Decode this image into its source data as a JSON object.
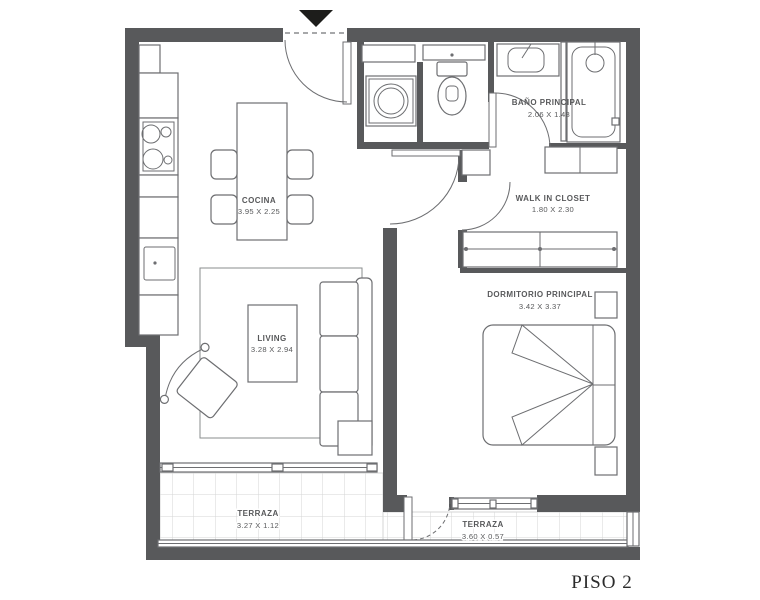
{
  "plan": {
    "floor_label": "PISO 2",
    "rooms": {
      "cocina": {
        "name": "COCINA",
        "dims": "3.95 X 2.25"
      },
      "living": {
        "name": "LIVING",
        "dims": "3.28 X 2.94"
      },
      "bano": {
        "name": "BAÑO PRINCIPAL",
        "dims": "2.06 X 1.48"
      },
      "closet": {
        "name": "WALK IN CLOSET",
        "dims": "1.80 X 2.30"
      },
      "dormitorio": {
        "name": "DORMITORIO PRINCIPAL",
        "dims": "3.42 X 3.37"
      },
      "terraza_living": {
        "name": "TERRAZA",
        "dims": "3.27 X 1.12"
      },
      "terraza_dormitorio": {
        "name": "TERRAZA",
        "dims": "3.60 X 0.57"
      }
    },
    "colors": {
      "wall": "#58595b",
      "text": "#58595b",
      "arrow": "#1d1d1b",
      "tile": "#d4d5d6"
    }
  }
}
